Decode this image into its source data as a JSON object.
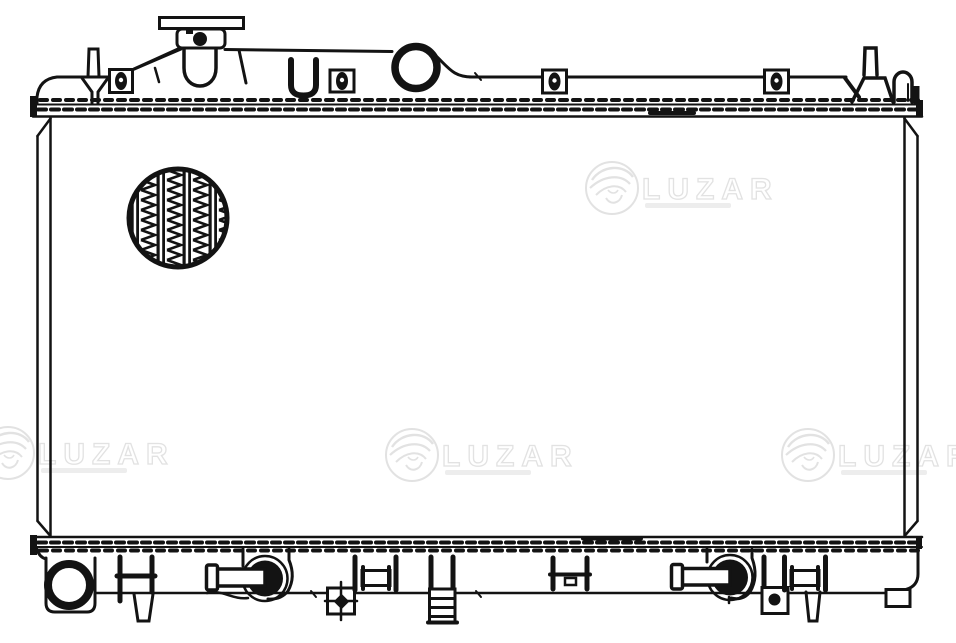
{
  "document": {
    "background_color": "#ffffff",
    "line_color": "#131313"
  },
  "watermark": {
    "text": "LUZAR",
    "color": "#e2e2e2",
    "subtext_color": "#ededed",
    "instances": [
      "top-right",
      "bottom-left",
      "bottom-center",
      "bottom-right"
    ]
  }
}
